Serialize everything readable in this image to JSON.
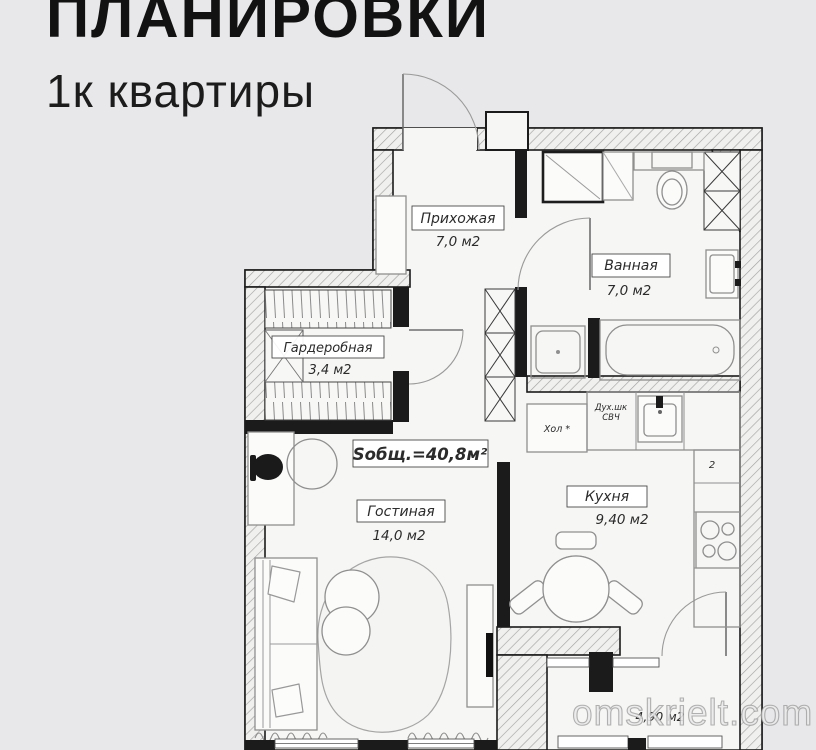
{
  "header": {
    "title": "ПЛАНИРОВКИ",
    "subtitle": "1к квартиры"
  },
  "watermark": {
    "text": "omskrielt.com"
  },
  "colors": {
    "background": "#e8e8ea",
    "paper": "#f6f6f4",
    "wall": "#1b1b1b"
  },
  "plan": {
    "total_area": "Sобщ.=40,8м²",
    "rooms": {
      "hallway": {
        "name": "Прихожая",
        "area": "7,0 м2"
      },
      "bathroom": {
        "name": "Ванная",
        "area": "7,0 м2"
      },
      "wardrobe": {
        "name": "Гардеробная",
        "area": "3,4 м2"
      },
      "living": {
        "name": "Гостиная",
        "area": "14,0 м2"
      },
      "kitchen": {
        "name": "Кухня",
        "area": "9,40 м2"
      },
      "balcony": {
        "area": "4,90 м2"
      }
    },
    "appliances": {
      "fridge": "Хол *",
      "oven": "Дух.шк",
      "microwave": "СВЧ",
      "cabinet": "2"
    }
  }
}
